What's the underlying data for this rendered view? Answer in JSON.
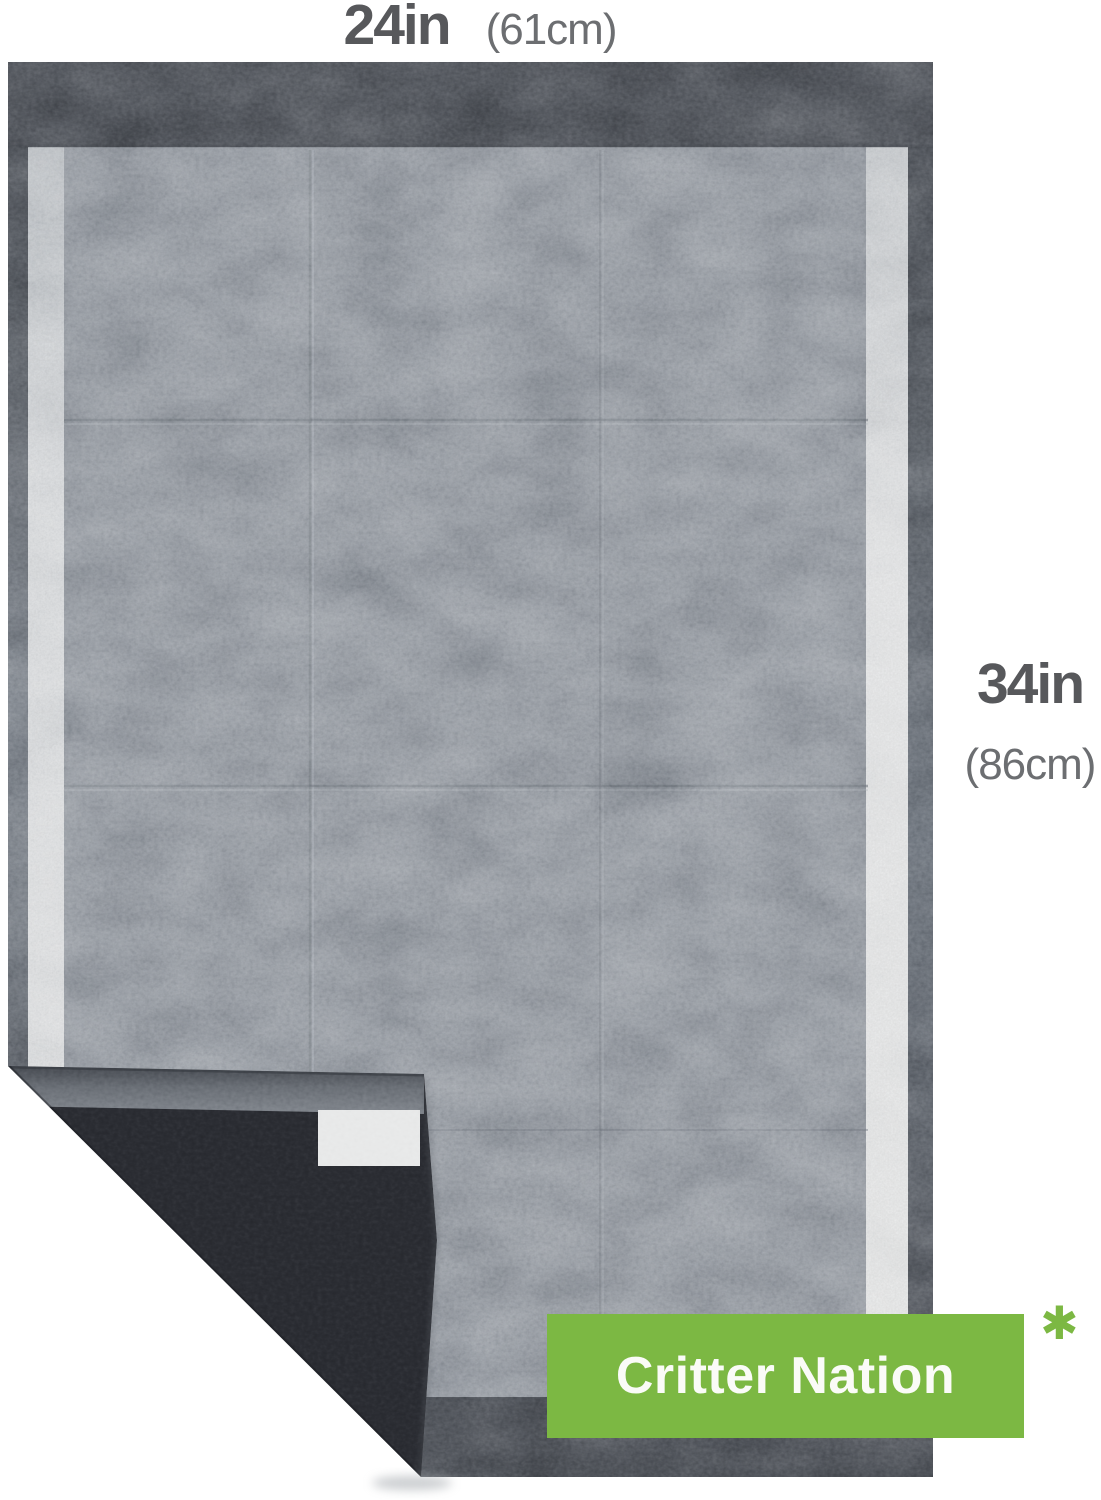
{
  "annotations": {
    "width": {
      "inches": "24in",
      "metric": "(61cm)"
    },
    "height": {
      "inches": "34in",
      "metric": "(86cm)"
    }
  },
  "brand_badge": {
    "label": "Critter Nation"
  },
  "footnote_marker": "✱",
  "colors": {
    "accent_green": "#7CB843",
    "dimension_text": "#57585B",
    "dimension_subtext": "#6C6E71",
    "badge_text": "#FAFBF7",
    "pad_surface_gray": "#A0A6AD",
    "pad_border_gray": "#5C6067",
    "pad_underside_black": "#2B2D33",
    "adhesive_tape_white": "#E8E9E9"
  }
}
